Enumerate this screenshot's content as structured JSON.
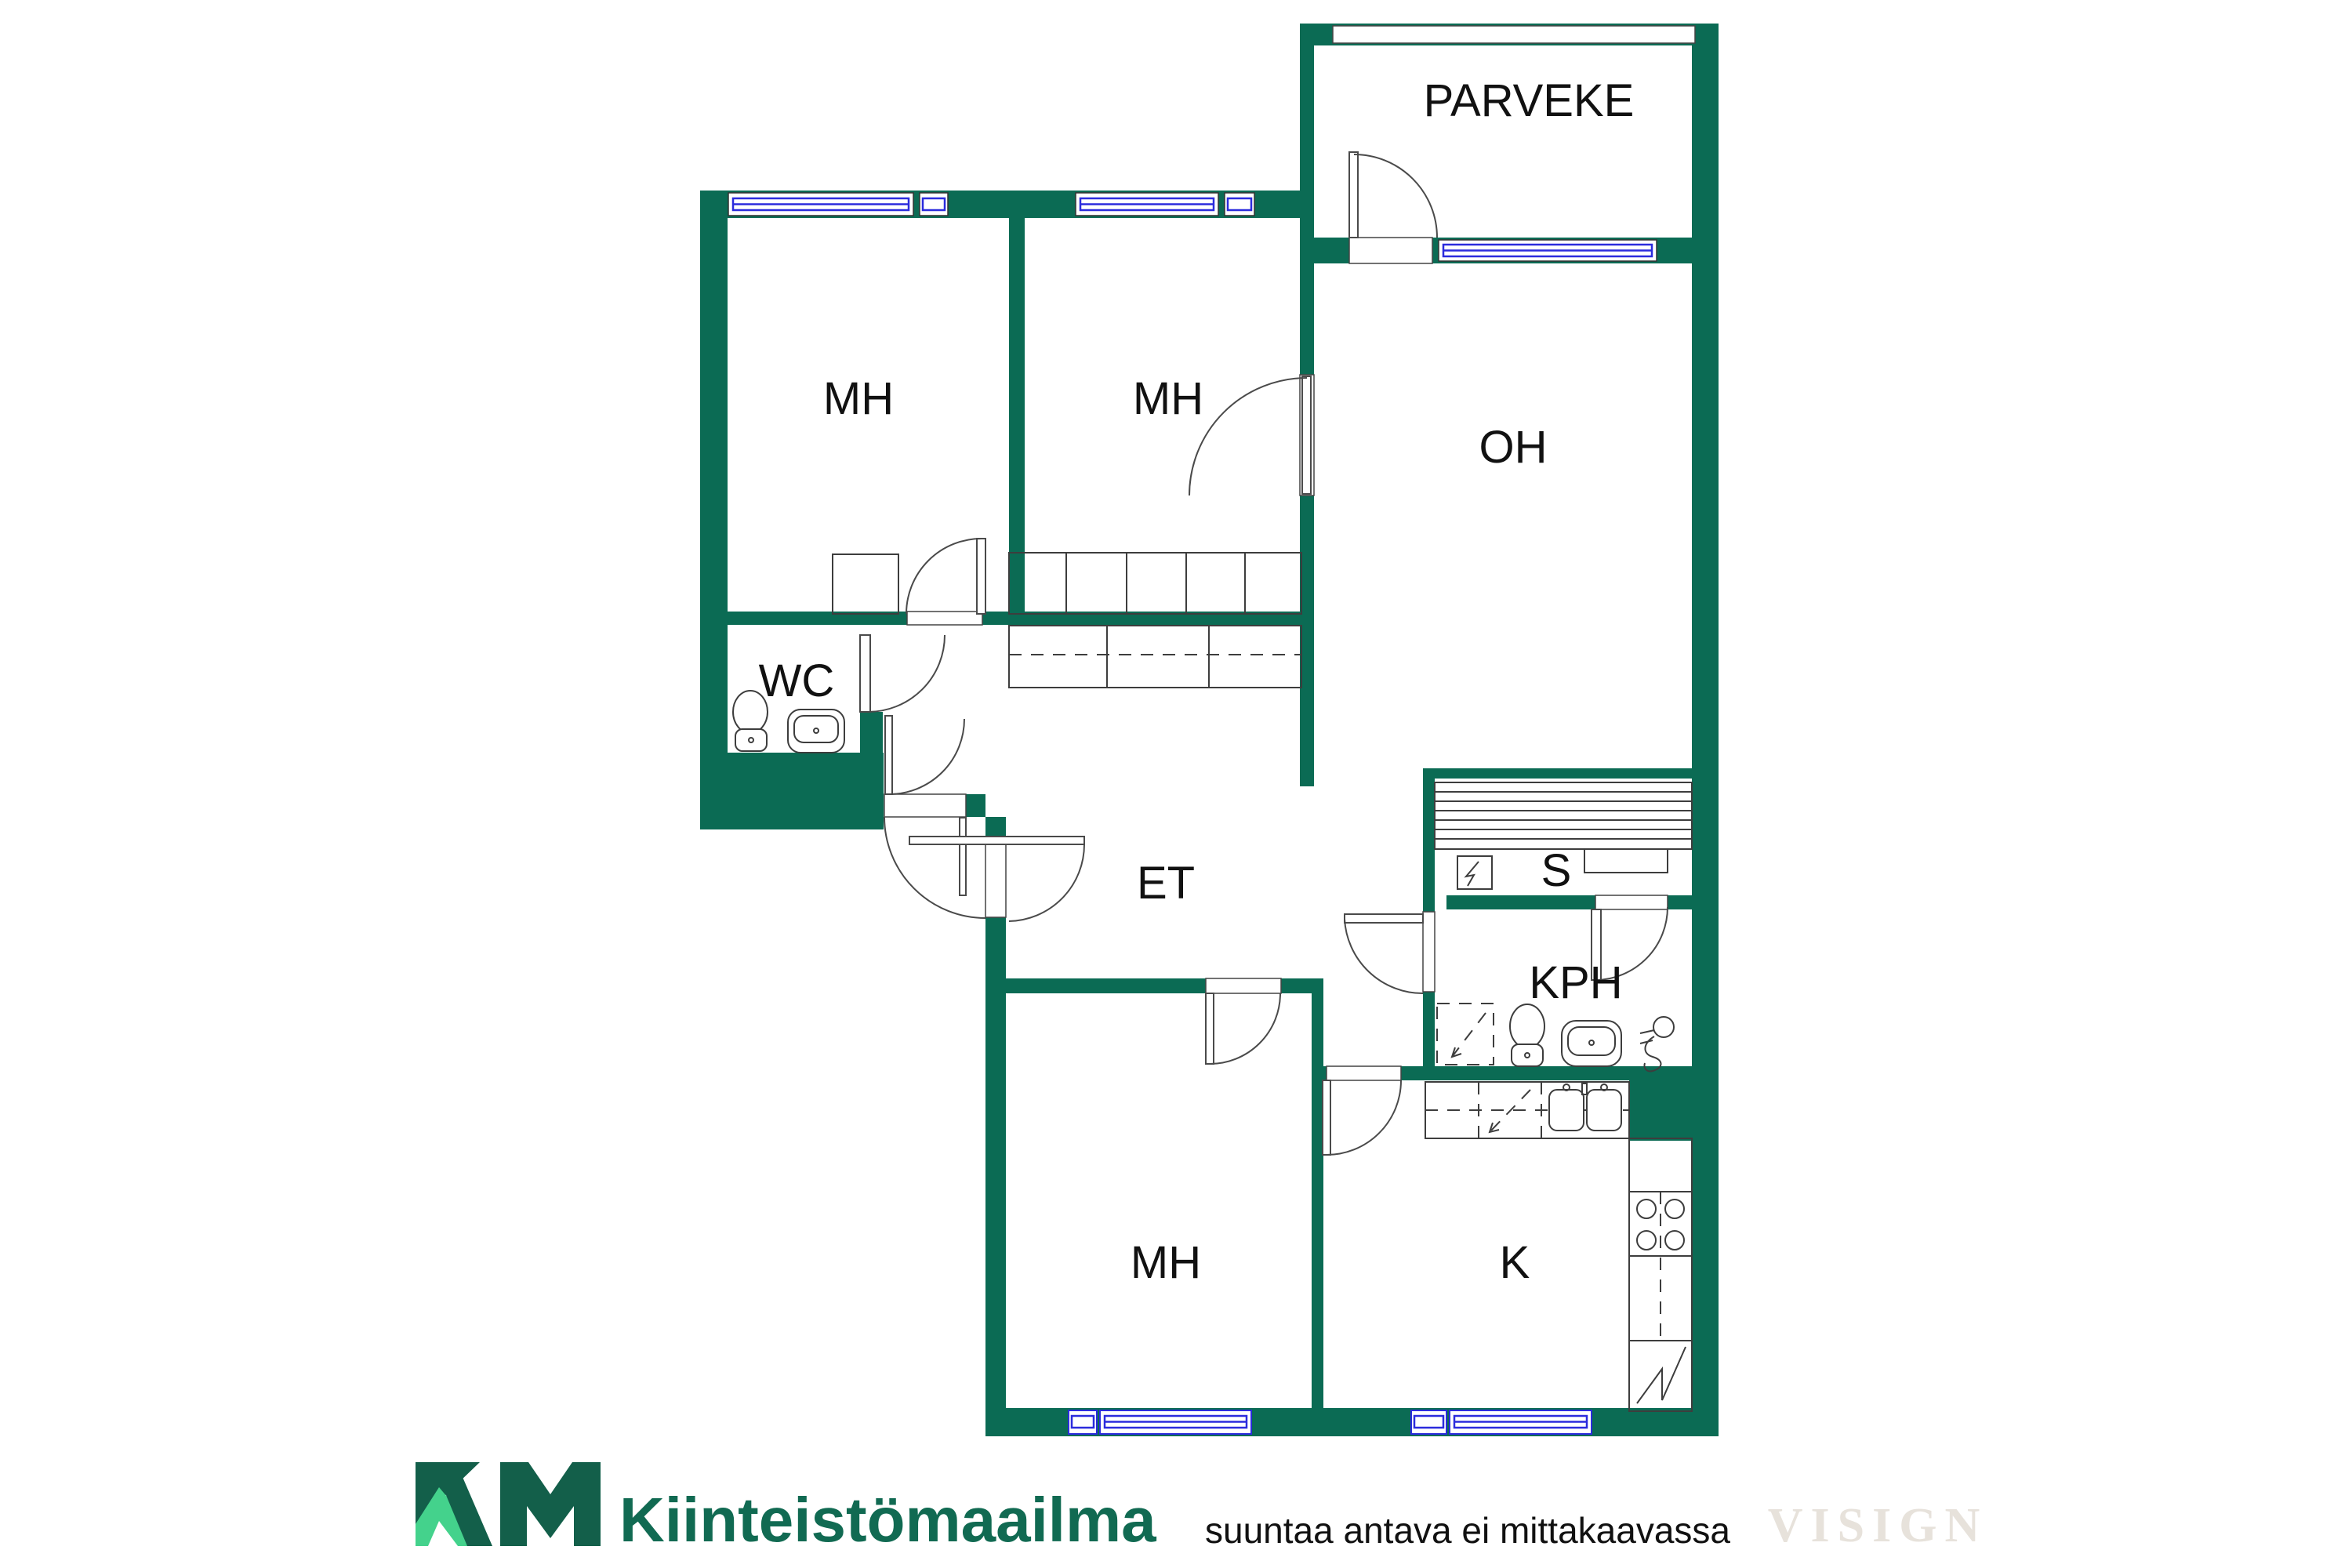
{
  "floorplan": {
    "colors": {
      "wall_green": "#0b6b54",
      "window_blue": "#2b2bdd",
      "fixture_outline": "#3d3d3d",
      "label_black": "#111111"
    },
    "rooms": [
      {
        "id": "parveke",
        "label": "PARVEKE"
      },
      {
        "id": "mh1",
        "label": "MH"
      },
      {
        "id": "mh2",
        "label": "MH"
      },
      {
        "id": "oh",
        "label": "OH"
      },
      {
        "id": "wc",
        "label": "WC"
      },
      {
        "id": "et",
        "label": "ET"
      },
      {
        "id": "s",
        "label": "S"
      },
      {
        "id": "kph",
        "label": "KPH"
      },
      {
        "id": "mh3",
        "label": "MH"
      },
      {
        "id": "k",
        "label": "K"
      }
    ]
  },
  "branding": {
    "monogram": "KM",
    "name": "Kiinteistömaailma",
    "dark_green": "#135f4a",
    "light_green": "#44d28c",
    "text_green": "#116a52"
  },
  "footer": {
    "disclaimer": "suuntaa antava ei mittakaavassa",
    "watermark": "VISIGN",
    "watermark_color": "#e7e2db"
  }
}
